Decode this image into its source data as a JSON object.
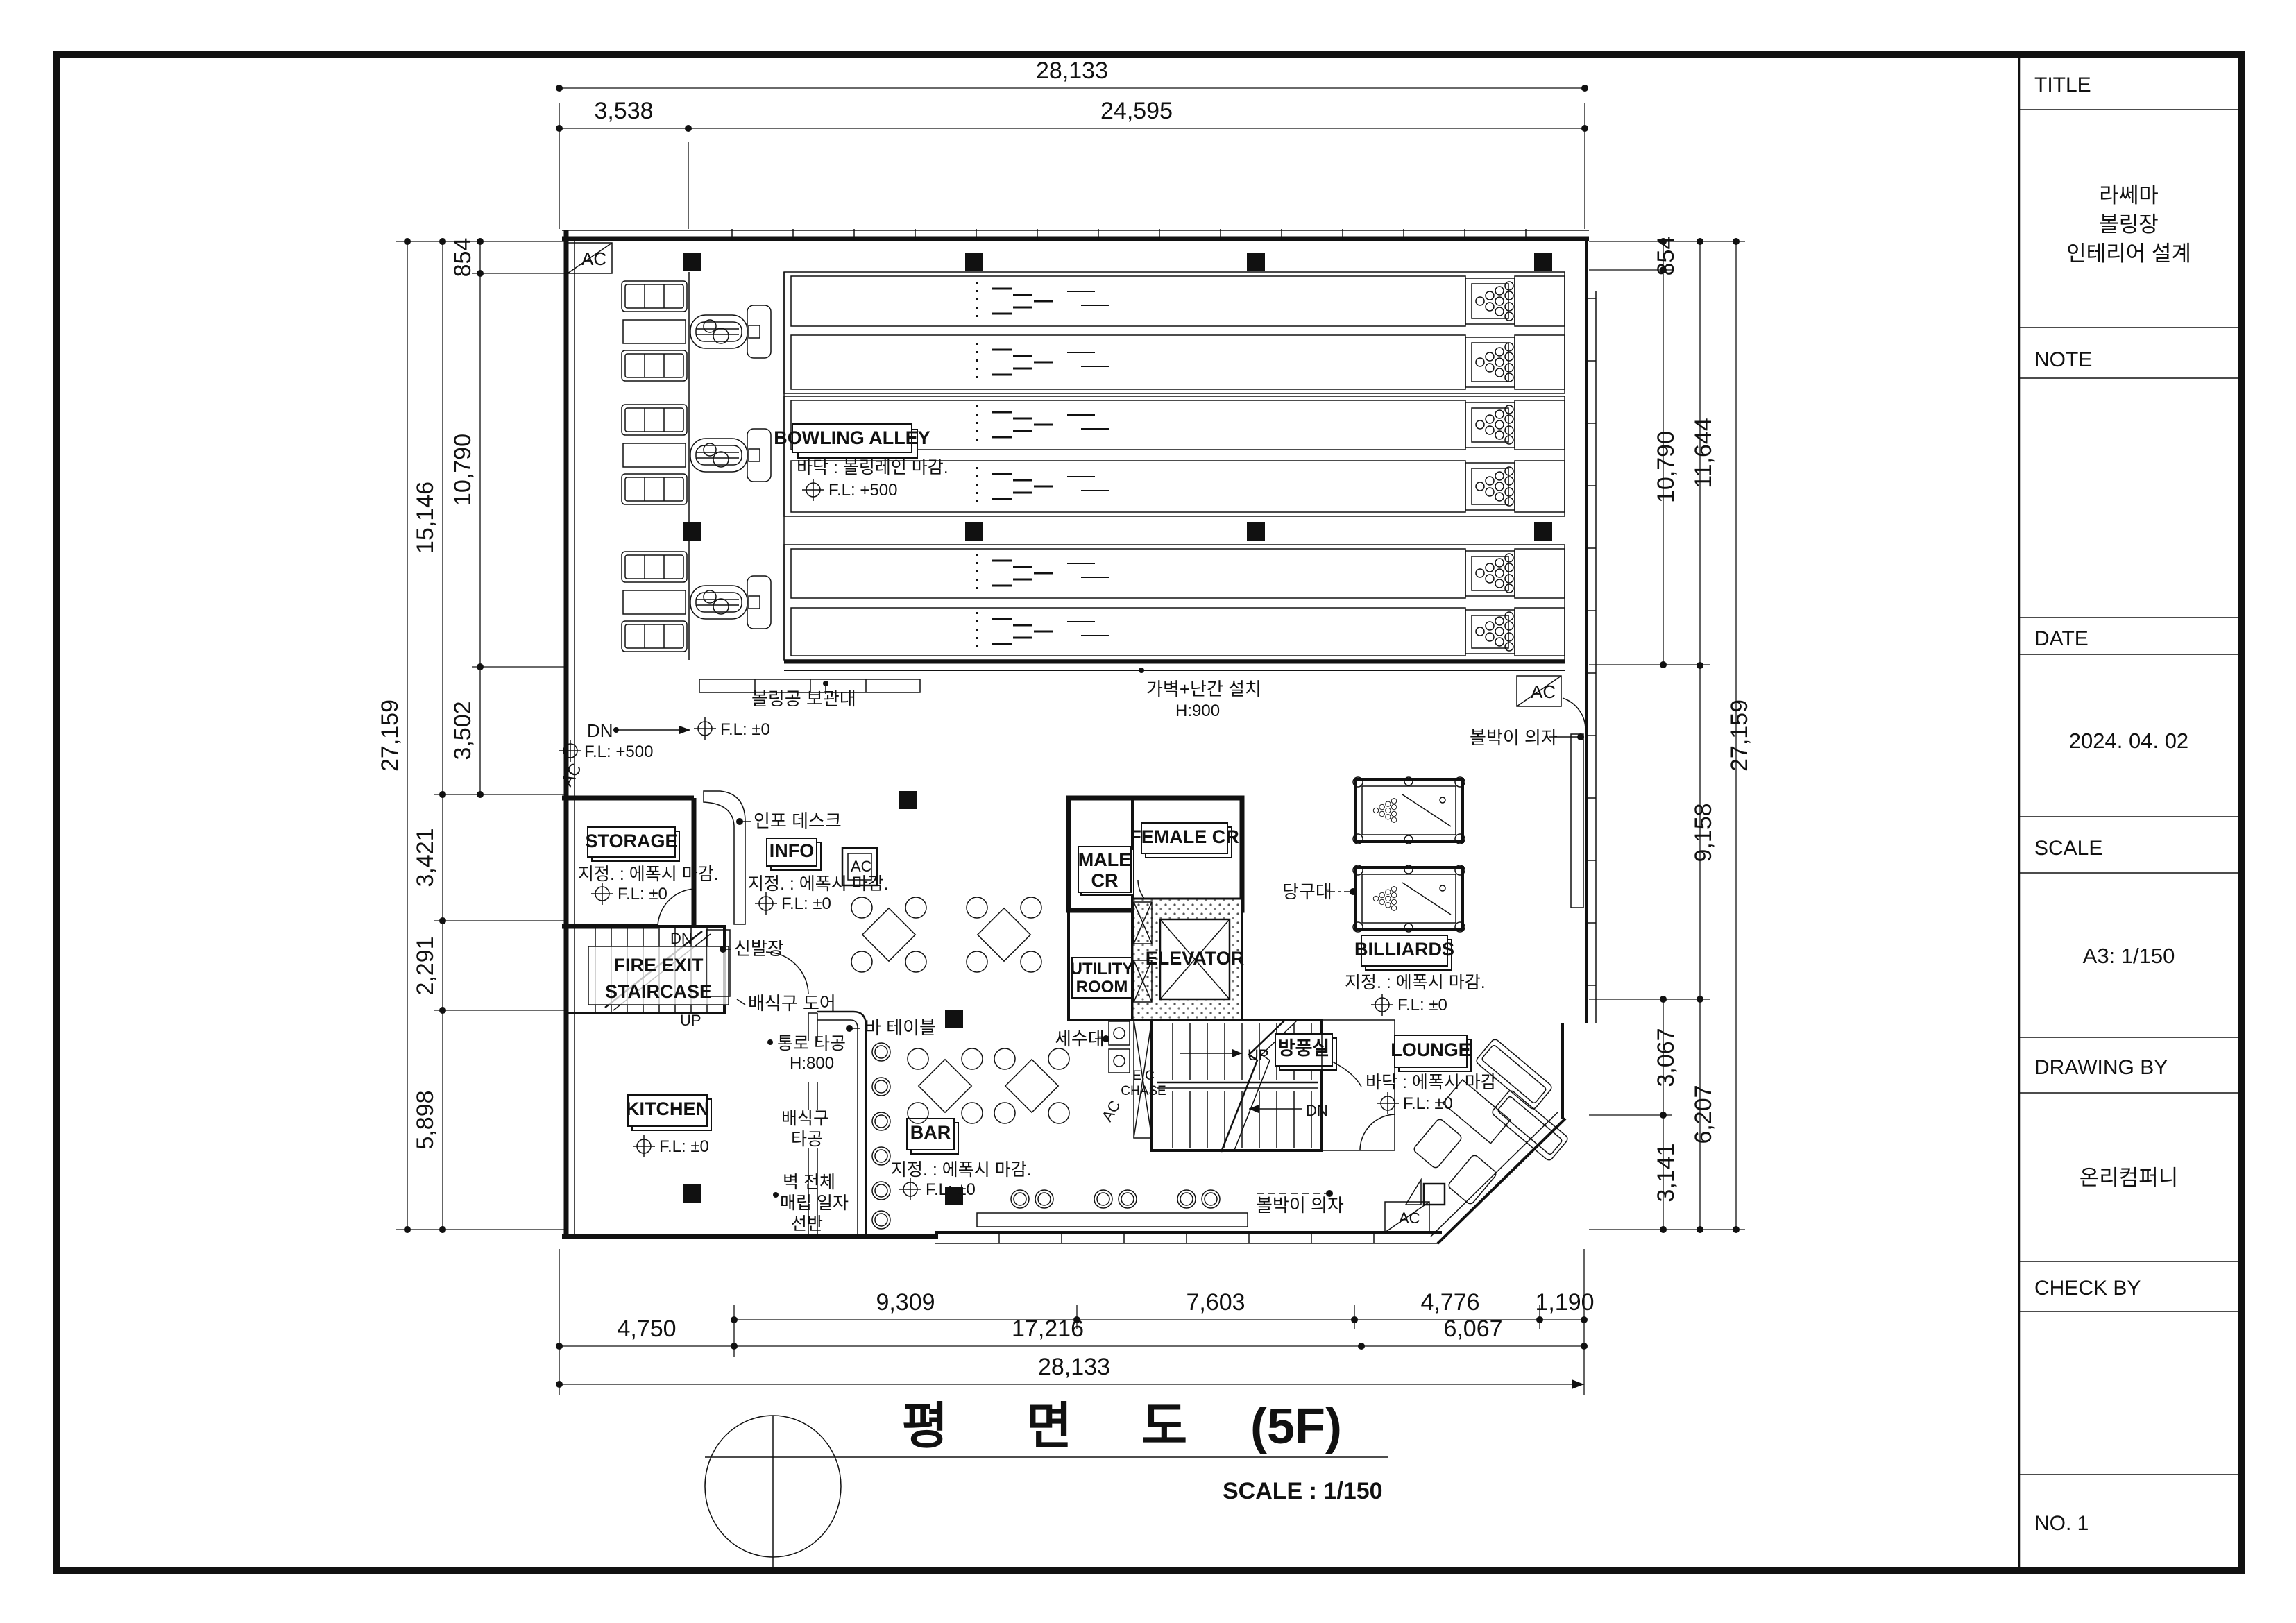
{
  "title_block": {
    "title_label": "TITLE",
    "project_title_lines": [
      "라쎄마",
      "볼링장",
      "인테리어 설계"
    ],
    "note_label": "NOTE",
    "date_label": "DATE",
    "date_value": "2024. 04. 02",
    "scale_label": "SCALE",
    "scale_value": "A3: 1/150",
    "drawing_by_label": "DRAWING BY",
    "drawing_by_value": "온리컴퍼니",
    "check_by_label": "CHECK BY",
    "sheet_no": "NO. 1"
  },
  "sheet_title": {
    "chars": [
      "평",
      "면",
      "도",
      "(5F)"
    ],
    "scale_note": "SCALE : 1/150"
  },
  "dimensions": {
    "top": {
      "overall": "28,133",
      "seg1": "3,538",
      "seg2": "24,595"
    },
    "left": {
      "overall": "27,159",
      "band": "15,146",
      "seg1": "854",
      "seg2": "10,790",
      "seg3": "3,502",
      "seg4": "3,421",
      "seg5": "2,291",
      "seg6": "5,898"
    },
    "right": {
      "overall": "27,159",
      "band": "11,644",
      "seg1": "854",
      "seg2": "10,790",
      "seg3": "9,158",
      "seg4": "3,067",
      "seg5": "6,207",
      "seg6": "3,141"
    },
    "bottom": {
      "overall": "28,133",
      "seg1": "9,309",
      "seg2": "7,603",
      "seg3": "4,776",
      "seg4": "1,190",
      "seg5": "4,750",
      "seg6": "17,216",
      "seg7": "6,067"
    }
  },
  "rooms": {
    "bowling_alley": {
      "name": "BOWLING ALLEY",
      "floor": "바닥 : 볼링레인 마감."
    },
    "storage": {
      "name": "STORAGE"
    },
    "info": {
      "name": "INFO"
    },
    "kitchen": {
      "name": "KITCHEN"
    },
    "bar": {
      "name": "BAR"
    },
    "male_cr": {
      "line1": "MALE",
      "line2": "CR"
    },
    "female_cr": {
      "name": "FEMALE CR"
    },
    "utility": {
      "line1": "UTILITY",
      "line2": "ROOM"
    },
    "elevator": {
      "name": "ELEVATOR"
    },
    "billiards": {
      "name": "BILLIARDS"
    },
    "lounge": {
      "name": "LOUNGE",
      "floor": "바닥 : 에폭시 마감"
    },
    "fire_exit": {
      "line1": "FIRE EXIT",
      "line2": "STAIRCASE"
    },
    "vestibule": {
      "name": "방풍실"
    }
  },
  "finishes": {
    "epoxy": "지정. : 에폭시 마감.",
    "level_zero": "F.L:  ±0",
    "level_500": "F.L:  +500"
  },
  "annotations": {
    "ball_rack": "볼링공 보관대",
    "half_wall": "가벽+난간 설치",
    "half_wall_h": "H:900",
    "info_desk": "인포 데스크",
    "shoe_cabinet": "신발장",
    "serving_door": "배식구 도어",
    "bar_table": "바 테이블",
    "passage_opening": "통로 타공",
    "passage_h": "H:800",
    "serving_opening1": "배식구",
    "serving_opening2": "타공",
    "wall_shelf1": "벽 전체",
    "wall_shelf2": "매립 일자",
    "wall_shelf3": "선반",
    "washstand": "세수대",
    "billiard_table": "당구대",
    "ball_chair": "볼박이 의자",
    "ec1": "E.C",
    "ec2": "CHASE"
  },
  "misc": {
    "ac": "AC",
    "dn": "DN",
    "up": "UP"
  }
}
